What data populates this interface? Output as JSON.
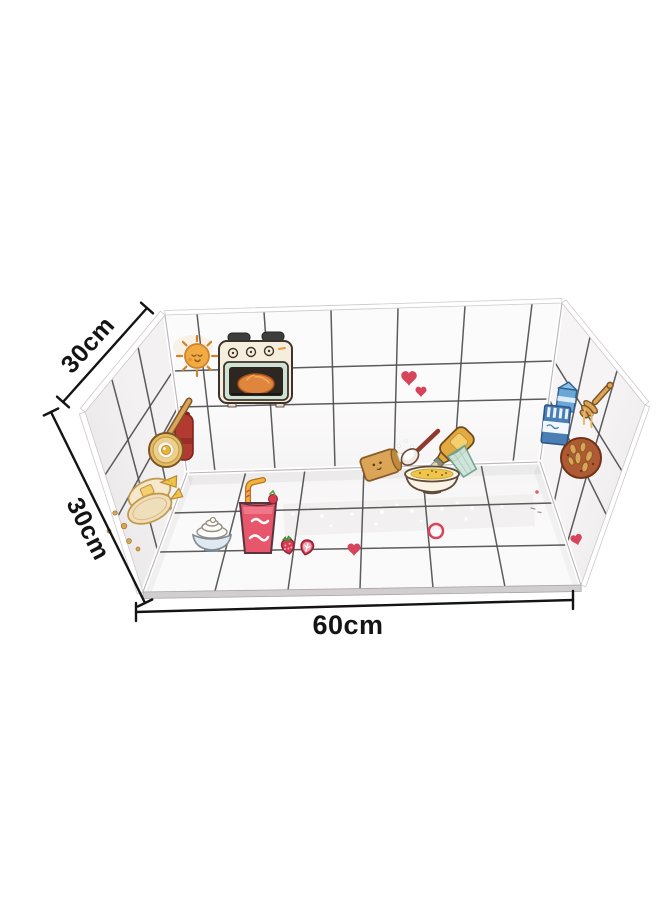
{
  "image": {
    "kind": "product-photo",
    "subject": "Foldable kitchen oil-proof tile sticker splash guard (three walls + base) decorated with cute cooking doodles",
    "background_color": "#ffffff"
  },
  "dimensions": {
    "top_left": {
      "label": "30cm"
    },
    "bottom_left": {
      "label": "30cm"
    },
    "bottom": {
      "label": "60cm"
    }
  },
  "colors": {
    "background": "#ffffff",
    "tile_line": "#4f4f4f",
    "measure_line": "#141414",
    "label_text": "#141414",
    "accent_red": "#d6455b",
    "strawberry_red": "#d93b52",
    "tan": "#dba558",
    "cream": "#f5ecd8",
    "orange": "#e8973c",
    "blue": "#4a7fb5",
    "mint_green": "#cfe3d4",
    "brown_outline": "#8a5a28"
  },
  "illustrations": [
    "sun",
    "oven-with-bread",
    "hearts",
    "flour-bag",
    "sugar-spoon",
    "oil-bottle",
    "glass-cup",
    "porridge-bowl",
    "milk-cartons",
    "honey-dipper",
    "nut-cookie",
    "kettle",
    "frying-pan-egg",
    "toast-with-cheese",
    "crumbs",
    "cream-bowl",
    "strawberry-juice",
    "strawberries",
    "floor-heart",
    "floor-ring",
    "sparkles"
  ]
}
